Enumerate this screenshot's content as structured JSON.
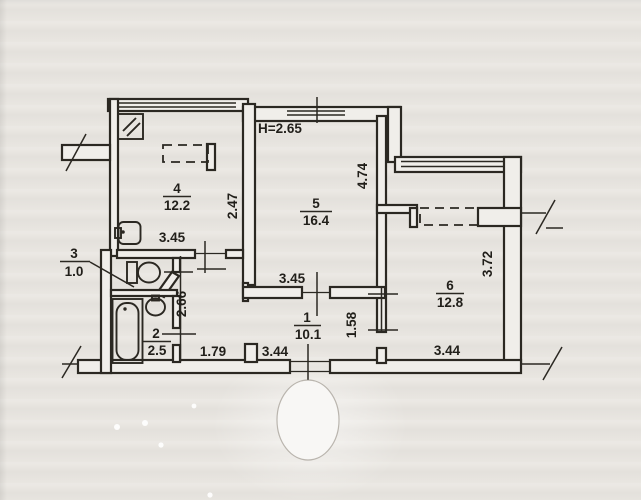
{
  "plan": {
    "title_note": "apartment floor plan scan",
    "ceiling_height_label": "H=2.65",
    "rooms": [
      {
        "number": "1",
        "area": "10.1"
      },
      {
        "number": "2",
        "area": "2.5"
      },
      {
        "number": "3",
        "area": "1.0"
      },
      {
        "number": "4",
        "area": "12.2"
      },
      {
        "number": "5",
        "area": "16.4"
      },
      {
        "number": "6",
        "area": "12.8"
      }
    ],
    "dimensions": {
      "room4_width": "3.45",
      "room4_depth": "2.47",
      "room5_width": "3.45",
      "room5_depth": "4.74",
      "room6_width": "3.44",
      "room6_depth": "3.72",
      "hall_width": "3.44",
      "hall_left_segment": "1.79",
      "left_block_depth": "2.66",
      "hall_right_depth": "1.58"
    },
    "colors": {
      "paper": "#e9e6e1",
      "ink": "#2b2822"
    }
  }
}
